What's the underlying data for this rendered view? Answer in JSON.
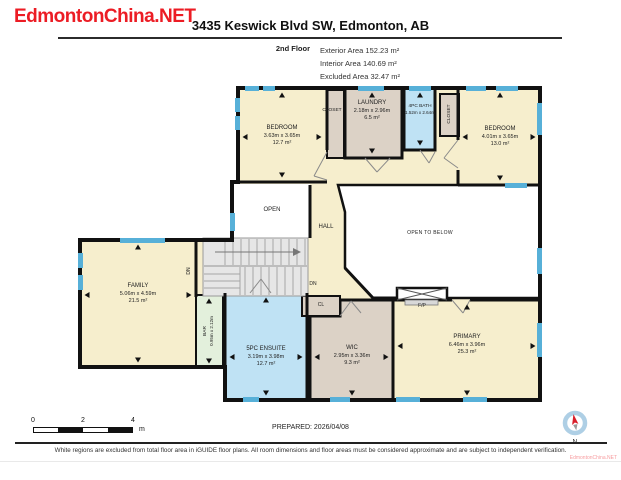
{
  "watermark": "EdmontonChina.NET",
  "header": {
    "title": "3435 Keswick Blvd SW, Edmonton, AB",
    "floor_label": "2nd Floor",
    "area_lines": [
      "Exterior Area 152.23 m²",
      "Interior Area 140.69 m²",
      "Excluded Area 32.47 m²"
    ]
  },
  "rooms": {
    "bedroom_left": {
      "name": "BEDROOM",
      "dims": "3.63m x 3.65m",
      "area": "12.7 m²"
    },
    "closet_left": {
      "name": "CLOSET"
    },
    "laundry": {
      "name": "LAUNDRY",
      "dims": "2.18m x 2.96m",
      "area": "6.5 m²"
    },
    "bath": {
      "name": "4PC BATH",
      "dims": "1.52m x 2.64m"
    },
    "closet_right": {
      "name": "CLOSET"
    },
    "bedroom_right": {
      "name": "BEDROOM",
      "dims": "4.01m x 3.65m",
      "area": "13.0 m²"
    },
    "open": {
      "name": "OPEN"
    },
    "hall": {
      "name": "HALL"
    },
    "open_to_below": {
      "name": "OPEN TO BELOW"
    },
    "family": {
      "name": "FAMILY",
      "dims": "5.06m x 4.59m",
      "area": "21.5 m²"
    },
    "bar": {
      "name": "BAR",
      "dims": "0.95m x 2.12m"
    },
    "ensuite": {
      "name": "5PC ENSUITE",
      "dims": "3.19m x 3.98m",
      "area": "12.7 m²"
    },
    "cl": {
      "name": "CL"
    },
    "wic": {
      "name": "WIC",
      "dims": "2.95m x 3.36m",
      "area": "9.3 m²"
    },
    "primary": {
      "name": "PRIMARY",
      "dims": "6.46m x 3.96m",
      "area": "25.3 m²"
    },
    "fireplace": {
      "name": "F/P"
    }
  },
  "labels": {
    "down": "DN"
  },
  "scale_bar": {
    "ticks": [
      "0",
      "2",
      "4"
    ],
    "unit": "m"
  },
  "footer": {
    "prepared": "PREPARED: 2026/04/08",
    "compass_label": "N",
    "disclaimer": "White regions are excluded from total floor area in iGUIDE floor plans. All room dimensions and floor areas must be considered approximate and are subject to independent verification."
  },
  "colors": {
    "watermark_red": "#EC1C24",
    "wall_black": "#111111",
    "room_beige": "#F6EECD",
    "room_taupe": "#DCD2C6",
    "room_blue": "#BFE2F4",
    "room_green": "#E3F0DC",
    "window_blue": "#57B0D8",
    "stairs_gray": "#E6E6E6"
  }
}
